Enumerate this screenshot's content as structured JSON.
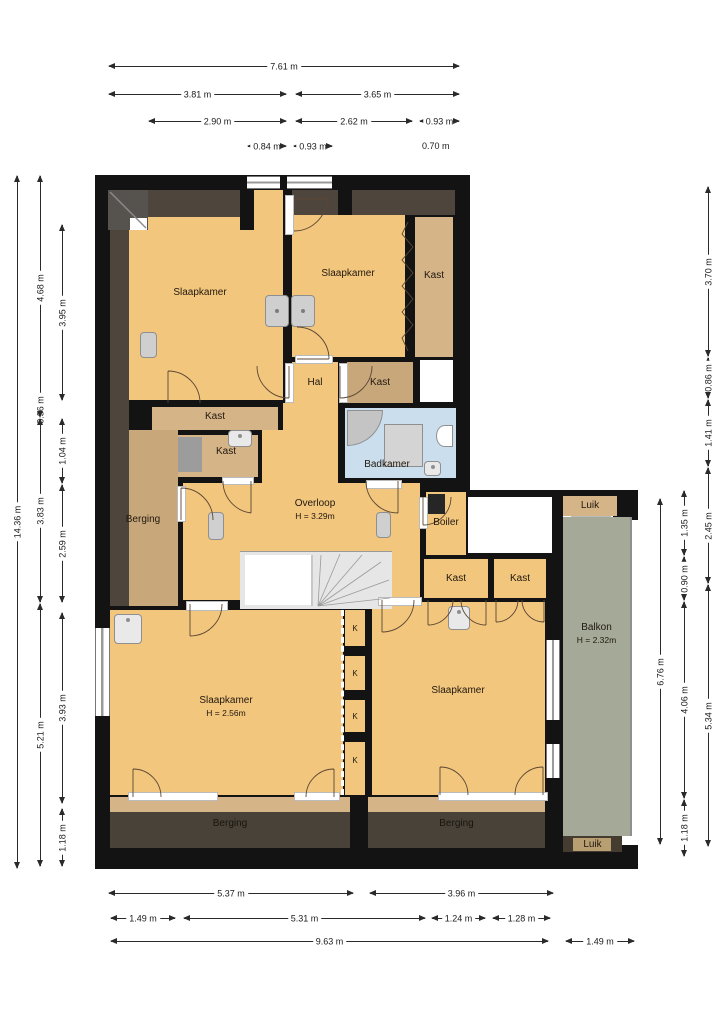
{
  "rooms": {
    "slaapkamer": "Slaapkamer",
    "kast": "Kast",
    "hal": "Hal",
    "badkamer": "Badkamer",
    "berging": "Berging",
    "overloop": "Overloop",
    "overloop_h": "H = 3.29m",
    "boiler": "Boiler",
    "luik": "Luik",
    "balkon": "Balkon",
    "balkon_h": "H = 2.32m",
    "slaapkamer_bl_h": "H = 2.56m",
    "k": "K"
  },
  "dimensions": {
    "top": [
      "7.61 m",
      "3.81 m",
      "3.65 m",
      "2.90 m",
      "2.62 m",
      "0.93 m",
      "0.84 m",
      "0.93 m",
      "0.70 m"
    ],
    "left": [
      "14.36 m",
      "4.68 m",
      "0.36 m",
      "3.83 m",
      "5.21 m",
      "3.95 m",
      "1.04 m",
      "2.59 m",
      "3.93 m",
      "1.18 m"
    ],
    "right": [
      "3.70 m",
      "0.86 m",
      "1.41 m",
      "2.45 m",
      "5.34 m",
      "1.35 m",
      "0.90 m",
      "4.06 m",
      "1.18 m",
      "6.76 m"
    ],
    "bottom": [
      "5.37 m",
      "3.96 m",
      "1.49 m",
      "5.31 m",
      "1.24 m",
      "1.28 m",
      "9.63 m",
      "1.49 m"
    ]
  },
  "colors": {
    "wall": "#131313",
    "floor": "#F3C67E",
    "closet_tan": "#D5B488",
    "closet_tan_dark": "#C8A77B",
    "attic_dark": "#4E463C",
    "storage_dark": "#484238",
    "bathroom_blue": "#CBDEEE",
    "balcony_green": "#A5A997"
  }
}
